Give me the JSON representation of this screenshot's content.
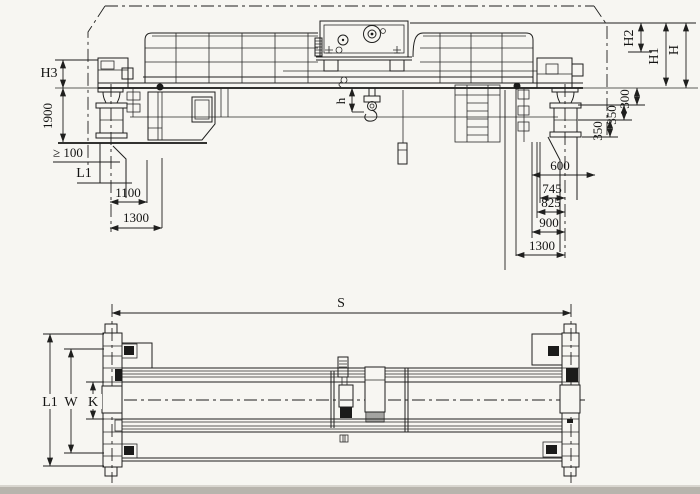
{
  "drawing_labels": {
    "elevation": {
      "H3": "H3",
      "v1900": "1900",
      "ge100": "≥ 100",
      "L1": "L1",
      "d1100": "1100",
      "d1300": "1300",
      "h": "h",
      "H2": "H2",
      "H1": "H1",
      "H": "H",
      "d300": "300",
      "d350a": "350",
      "d350b": "350",
      "d600": "600",
      "d745": "745",
      "d825": "825",
      "d900": "900",
      "d1300b": "1300"
    },
    "plan": {
      "S": "S",
      "L1": "L1",
      "W": "W",
      "K": "K"
    }
  },
  "colors": {
    "line": "#1f1f1e",
    "paper": "#f7f6f2",
    "scan_band": "#b8b4ad"
  }
}
